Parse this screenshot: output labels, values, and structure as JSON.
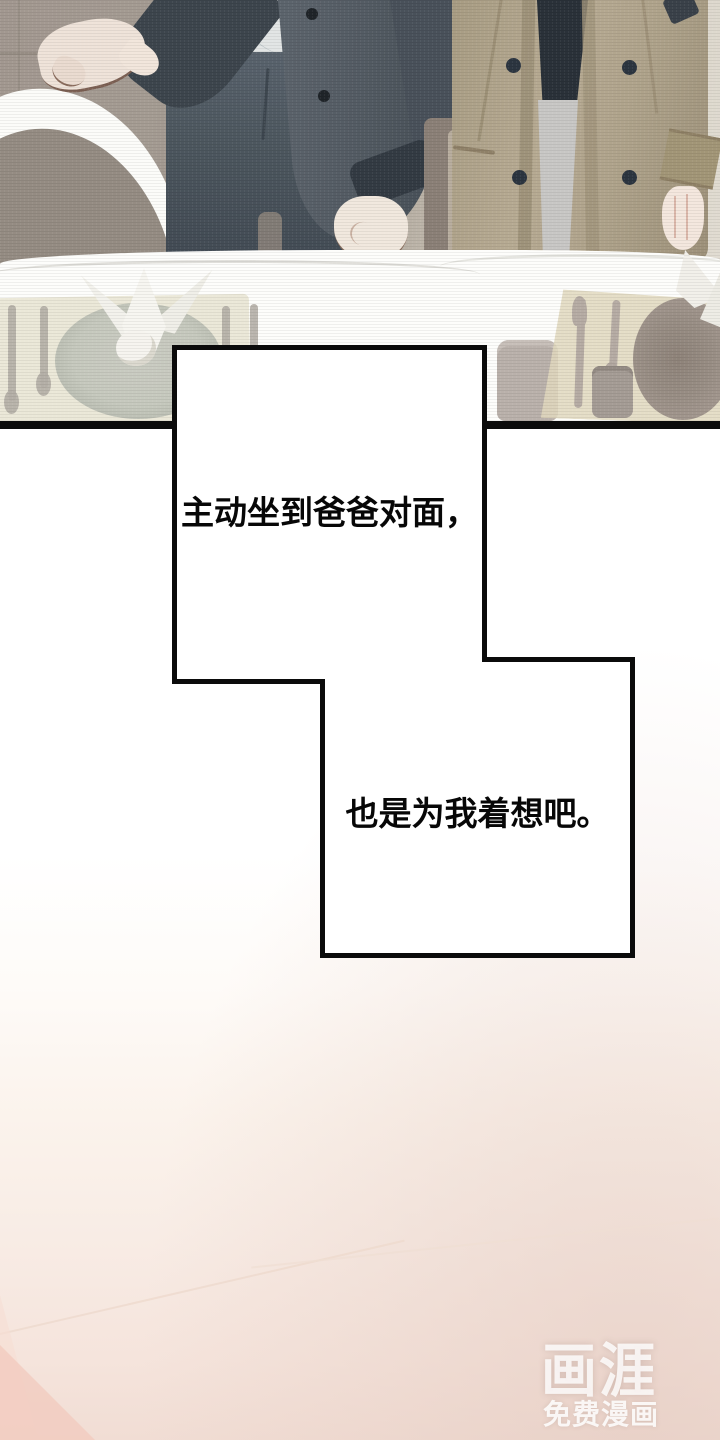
{
  "captions": {
    "caption1": "主动坐到爸爸对面，",
    "caption2": "也是为我着想吧。"
  },
  "watermark": {
    "logo": "画涯",
    "subtitle": "免费漫画"
  },
  "colors": {
    "panel_border": "#0b0b0b",
    "caption_text": "#070707",
    "caption_box_fill": "#ffffff",
    "left_jacket": "#49525a",
    "left_shirt": "#e2e5e5",
    "left_pants": "#4d575f",
    "right_coat": "#b3a78f",
    "right_inner_shirt": "#2a3139",
    "right_pants": "#c8c7c5",
    "wall": "#a29890",
    "table": "#fdfdfb",
    "placemat": "#e0d8bd",
    "bottom_blush": "#f5e4dc",
    "watermark_white": "rgba(255,255,255,0.8)"
  }
}
